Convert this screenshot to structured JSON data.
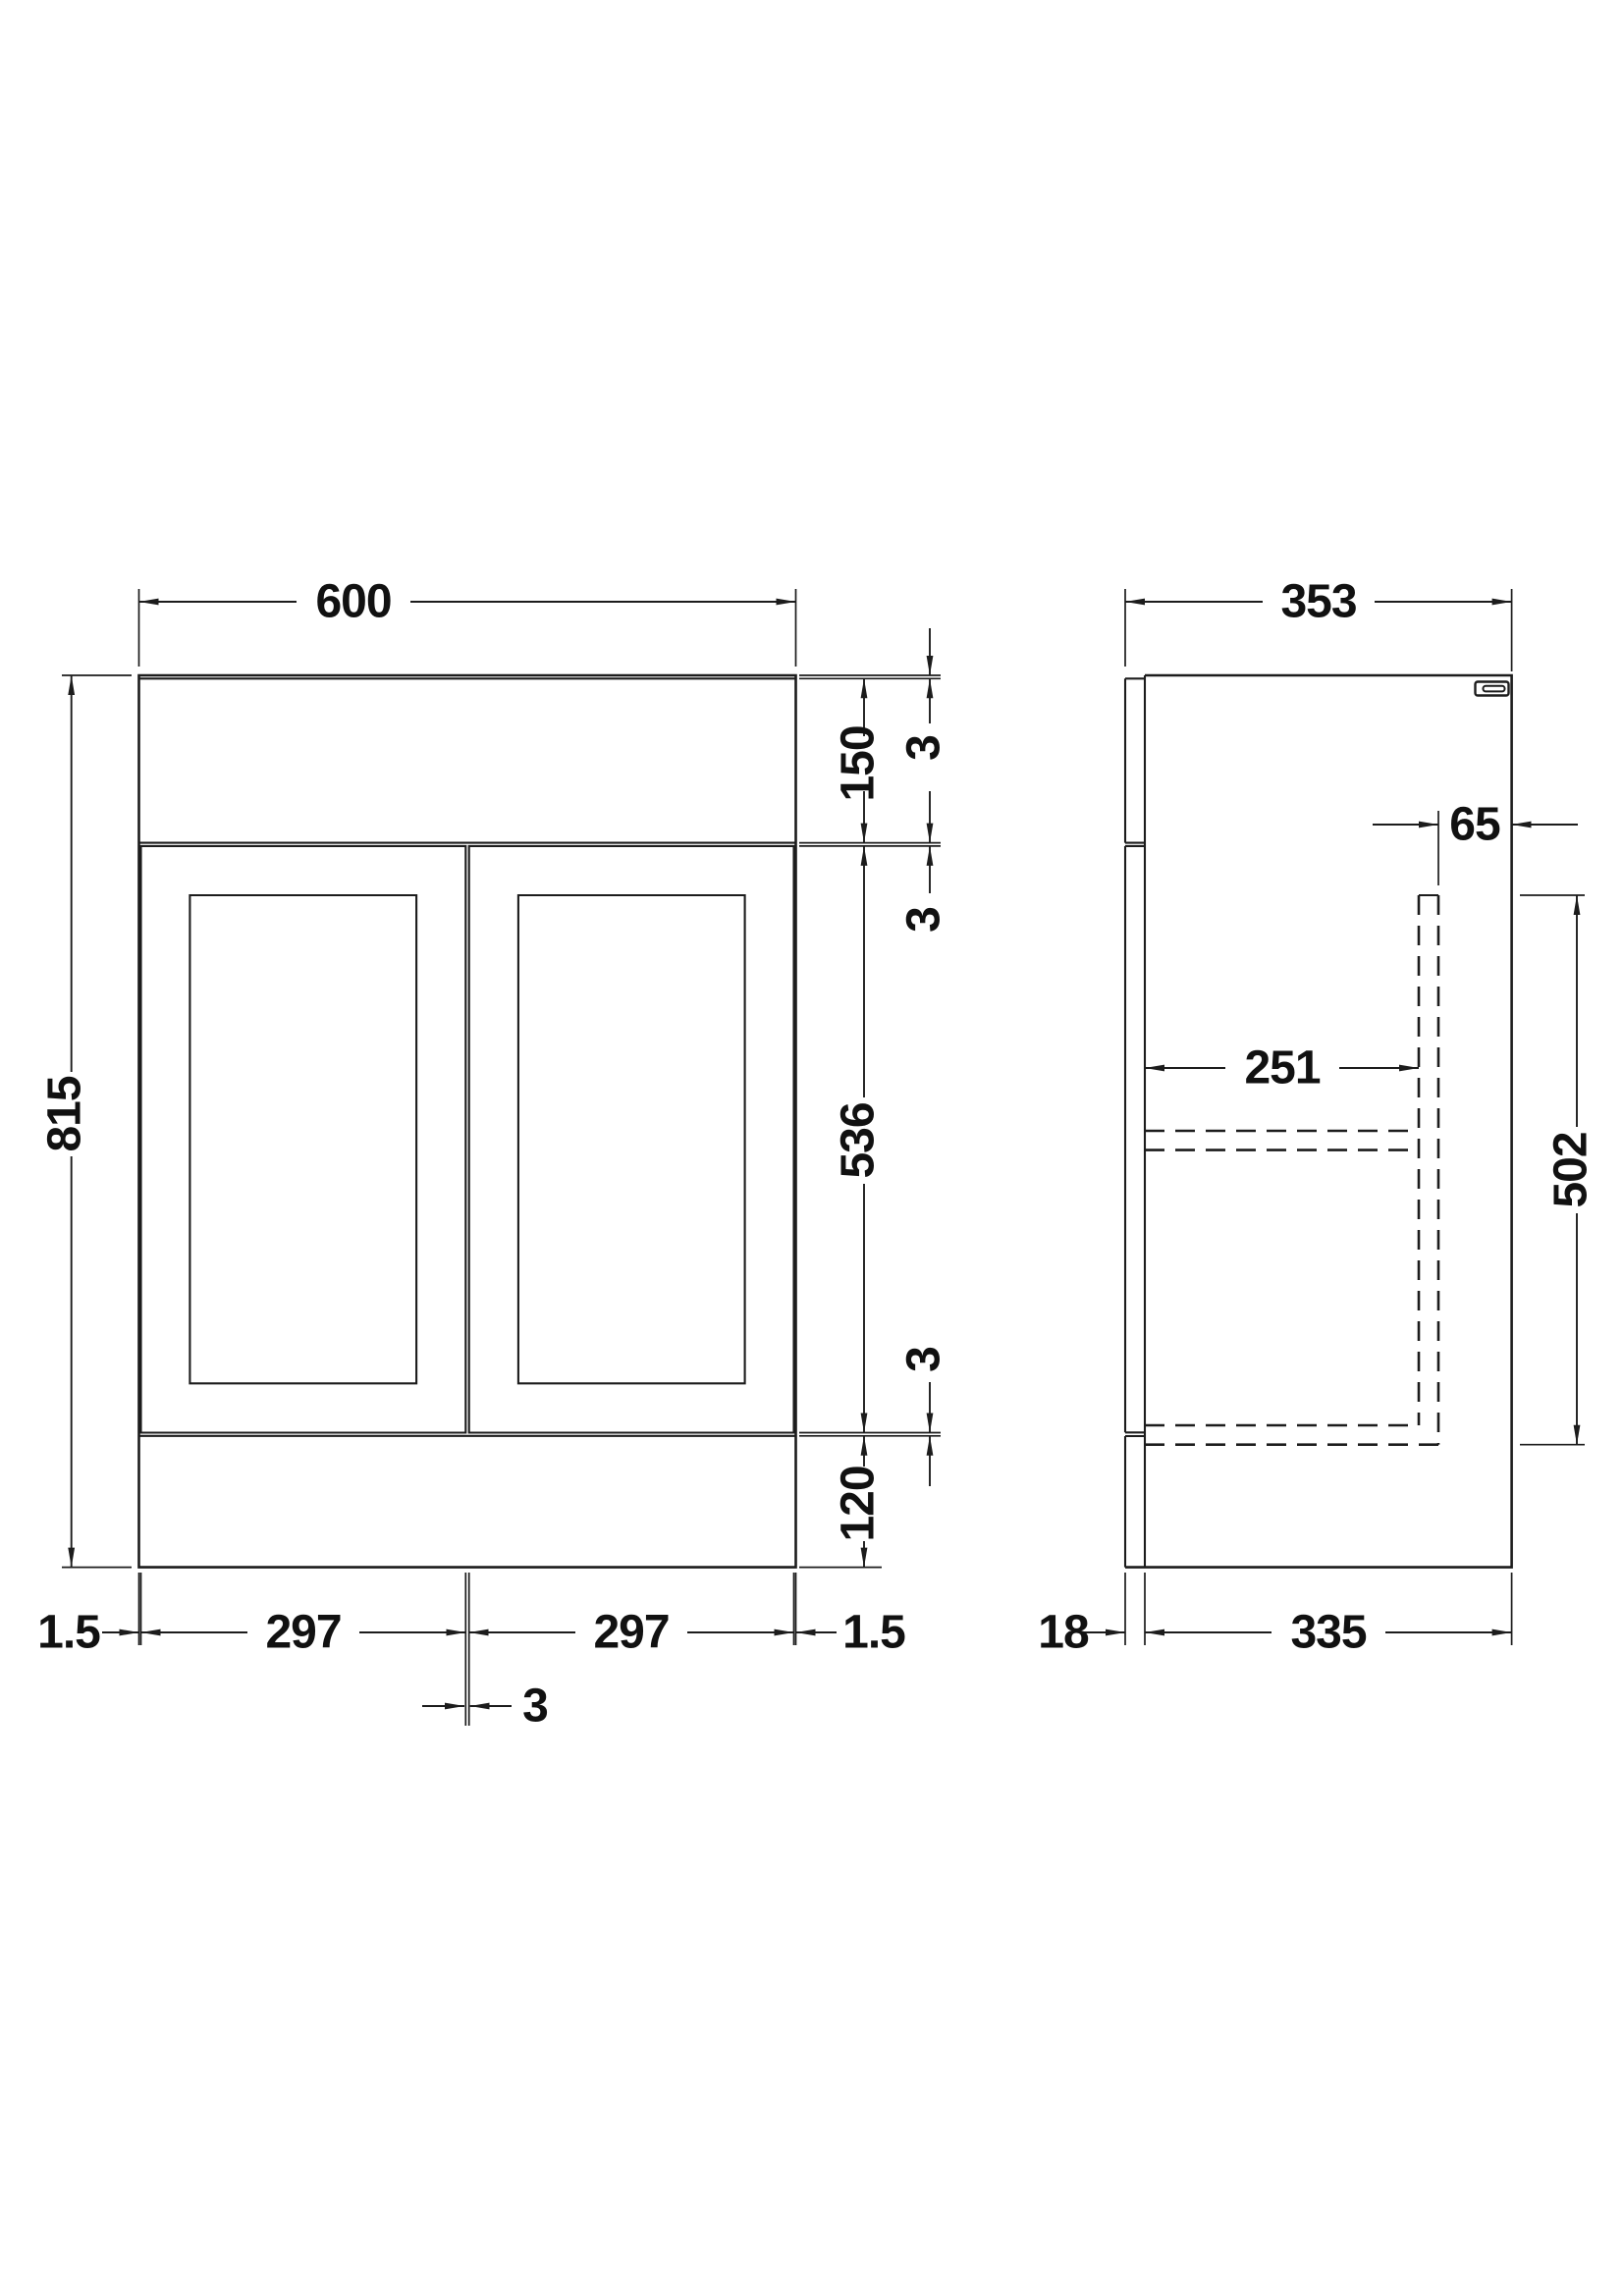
{
  "drawing": {
    "title": "vanity-unit-technical-drawing",
    "background_color": "#ffffff",
    "line_color": "#1c1c1c",
    "text_color": "#111111"
  },
  "front_view": {
    "width": "600",
    "height": "815",
    "worktop_edge": "3",
    "top_band_height": "150",
    "door_top_gap": "3",
    "door_height": "536",
    "door_bottom_gap": "3",
    "plinth_height": "120",
    "left_reveal": "1.5",
    "left_door_width": "297",
    "door_gap": "3",
    "right_door_width": "297",
    "right_reveal": "1.5"
  },
  "side_view": {
    "depth": "353",
    "back_recess": "65",
    "internal_depth": "251",
    "duct_height": "502",
    "front_panel_thickness": "18",
    "carcass_depth": "335"
  }
}
